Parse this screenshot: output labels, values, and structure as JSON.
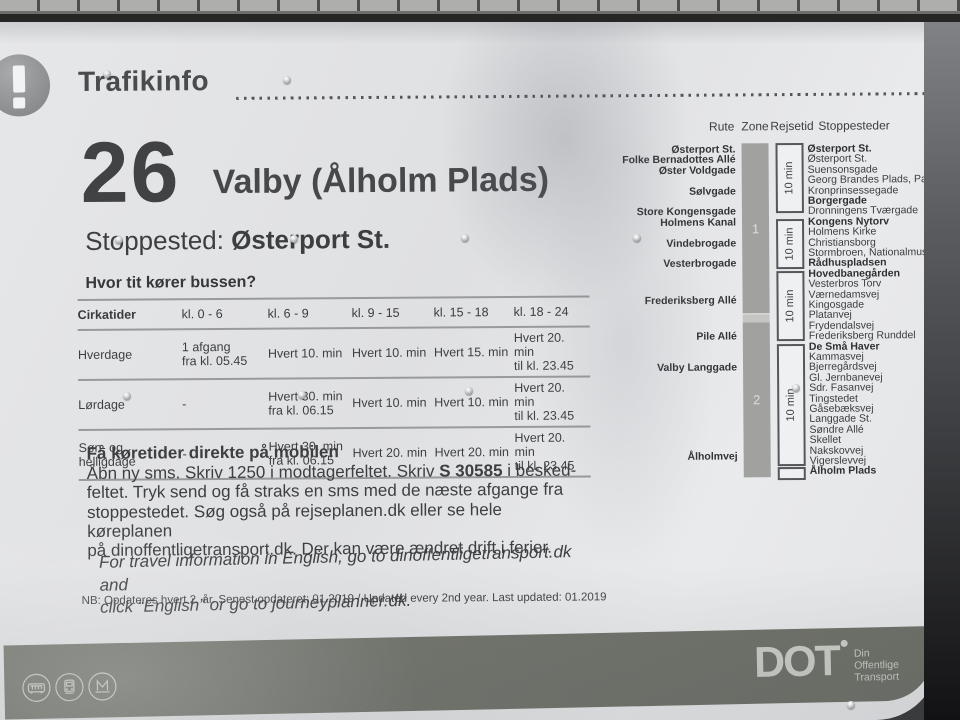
{
  "sign": {
    "header": {
      "title": "Trafikinfo"
    },
    "route": {
      "number": "26",
      "name": "Valby (Ålholm Plads)"
    },
    "stop_line": {
      "label": "Stoppested:",
      "value": "Østerport St."
    },
    "frequency": {
      "question": "Hvor tit kører bussen?",
      "columns": [
        "Cirkatider",
        "kl. 0 - 6",
        "kl. 6 - 9",
        "kl. 9 - 15",
        "kl. 15 - 18",
        "kl. 18 - 24"
      ],
      "rows": [
        {
          "label": "Hverdage",
          "cells": [
            "1 afgang\nfra kl. 05.45",
            "Hvert 10. min",
            "Hvert 10. min",
            "Hvert 15. min",
            "Hvert 20. min\ntil kl. 23.45"
          ]
        },
        {
          "label": "Lørdage",
          "cells": [
            "-",
            "Hvert 30. min\nfra kl. 06.15",
            "Hvert 10. min",
            "Hvert 10. min",
            "Hvert 20. min\ntil kl. 23.45"
          ]
        },
        {
          "label": "Søn- og\nhelligdage",
          "cells": [
            "-",
            "Hvert 30. min\nfra kl. 06.15",
            "Hvert 20. min",
            "Hvert 20. min",
            "Hvert 20. min\ntil kl. 23.45"
          ]
        }
      ]
    },
    "sms": {
      "title": "Få køretider direkte på mobilen",
      "line1_pre": "Åbn ny sms. Skriv 1250 i modtagerfeltet. Skriv ",
      "line1_code": "S 30585",
      "line1_post": " i besked-",
      "line2": "feltet. Tryk send og få straks en sms med de næste afgange fra",
      "line3": "stoppestedet. Søg også på rejseplanen.dk eller se hele køreplanen",
      "line4": "på dinoffentligetransport.dk. Der kan være ændret drift i ferier."
    },
    "english_note": {
      "line1": "For travel information in English, go to dinoffentligetransport.dk and",
      "line2": "click “English” or go to journeyplanner.dk."
    },
    "update_note": "NB: Opdateres hvert 2. år. Senest opdateret: 01.2019 / Updated every 2nd year. Last updated: 01.2019",
    "diagram": {
      "headers": {
        "rute": "Rute",
        "zone": "Zone",
        "rejsetid": "Rejsetid",
        "stoppesteder": "Stoppesteder"
      },
      "streets": [
        {
          "name": "Østerport St.",
          "row": 0
        },
        {
          "name": "Folke Bernadottes Allé",
          "row": 1
        },
        {
          "name": "Øster Voldgade",
          "row": 2
        },
        {
          "name": "Sølvgade",
          "row": 4
        },
        {
          "name": "Store Kongensgade",
          "row": 6
        },
        {
          "name": "Holmens Kanal",
          "row": 7
        },
        {
          "name": "Vindebrogade",
          "row": 9
        },
        {
          "name": "Vesterbrogade",
          "row": 11
        },
        {
          "name": "Frederiksberg Allé",
          "row": 14.5
        },
        {
          "name": "Pile Allé",
          "row": 18
        },
        {
          "name": "Valby Langgade",
          "row": 21
        },
        {
          "name": "Ålholmvej",
          "row": 29.5
        }
      ],
      "zones": [
        {
          "label": "1",
          "from_row": 0,
          "to_row": 15.6
        },
        {
          "label": "2",
          "from_row": 17.2,
          "to_row": 31.3
        }
      ],
      "travel_times": [
        {
          "label": "10 min",
          "from_row": 0,
          "to_row": 6
        },
        {
          "label": "10 min",
          "from_row": 7.3,
          "to_row": 11.3
        },
        {
          "label": "10 min",
          "from_row": 12.3,
          "to_row": 18.3
        },
        {
          "label": "10 min",
          "from_row": 19.3,
          "to_row": 30.3
        },
        {
          "label": "",
          "from_row": 31.2,
          "to_row": 31.6
        }
      ],
      "stops": [
        {
          "name": "Østerport St.",
          "bold": true
        },
        {
          "name": "Østerport St.",
          "bold": false
        },
        {
          "name": "Suensonsgade",
          "bold": false
        },
        {
          "name": "Georg Brandes Plads, Parkmus",
          "bold": false
        },
        {
          "name": "Kronprinsessegade",
          "bold": false
        },
        {
          "name": "Borgergade",
          "bold": true
        },
        {
          "name": "Dronningens Tværgade",
          "bold": false
        },
        {
          "name": "Kongens Nytorv",
          "bold": true
        },
        {
          "name": "Holmens Kirke",
          "bold": false
        },
        {
          "name": "Christiansborg",
          "bold": false
        },
        {
          "name": "Stormbroen, Nationalmuseet",
          "bold": false
        },
        {
          "name": "Rådhuspladsen",
          "bold": true
        },
        {
          "name": "Hovedbanegården",
          "bold": true
        },
        {
          "name": "Vesterbros Torv",
          "bold": false
        },
        {
          "name": "Værnedamsvej",
          "bold": false
        },
        {
          "name": "Kingosgade",
          "bold": false
        },
        {
          "name": "Platanvej",
          "bold": false
        },
        {
          "name": "Frydendalsvej",
          "bold": false
        },
        {
          "name": "Frederiksberg Runddel",
          "bold": false
        },
        {
          "name": "De Små Haver",
          "bold": true
        },
        {
          "name": "Kammasvej",
          "bold": false
        },
        {
          "name": "Bjerregårdsvej",
          "bold": false
        },
        {
          "name": "Gl. Jernbanevej",
          "bold": false
        },
        {
          "name": "Sdr. Fasanvej",
          "bold": false
        },
        {
          "name": "Tingstedet",
          "bold": false
        },
        {
          "name": "Gåsebæksvej",
          "bold": false
        },
        {
          "name": "Langgade St.",
          "bold": false
        },
        {
          "name": "Søndre Allé",
          "bold": false
        },
        {
          "name": "Skellet",
          "bold": false
        },
        {
          "name": "Nakskovvej",
          "bold": false
        },
        {
          "name": "Vigerslevvej",
          "bold": false
        },
        {
          "name": "Ålholm Plads",
          "bold": true
        }
      ]
    },
    "footer": {
      "logo": "DOT",
      "tagline_lines": [
        "Din",
        "Offentlige",
        "Transport"
      ]
    }
  }
}
